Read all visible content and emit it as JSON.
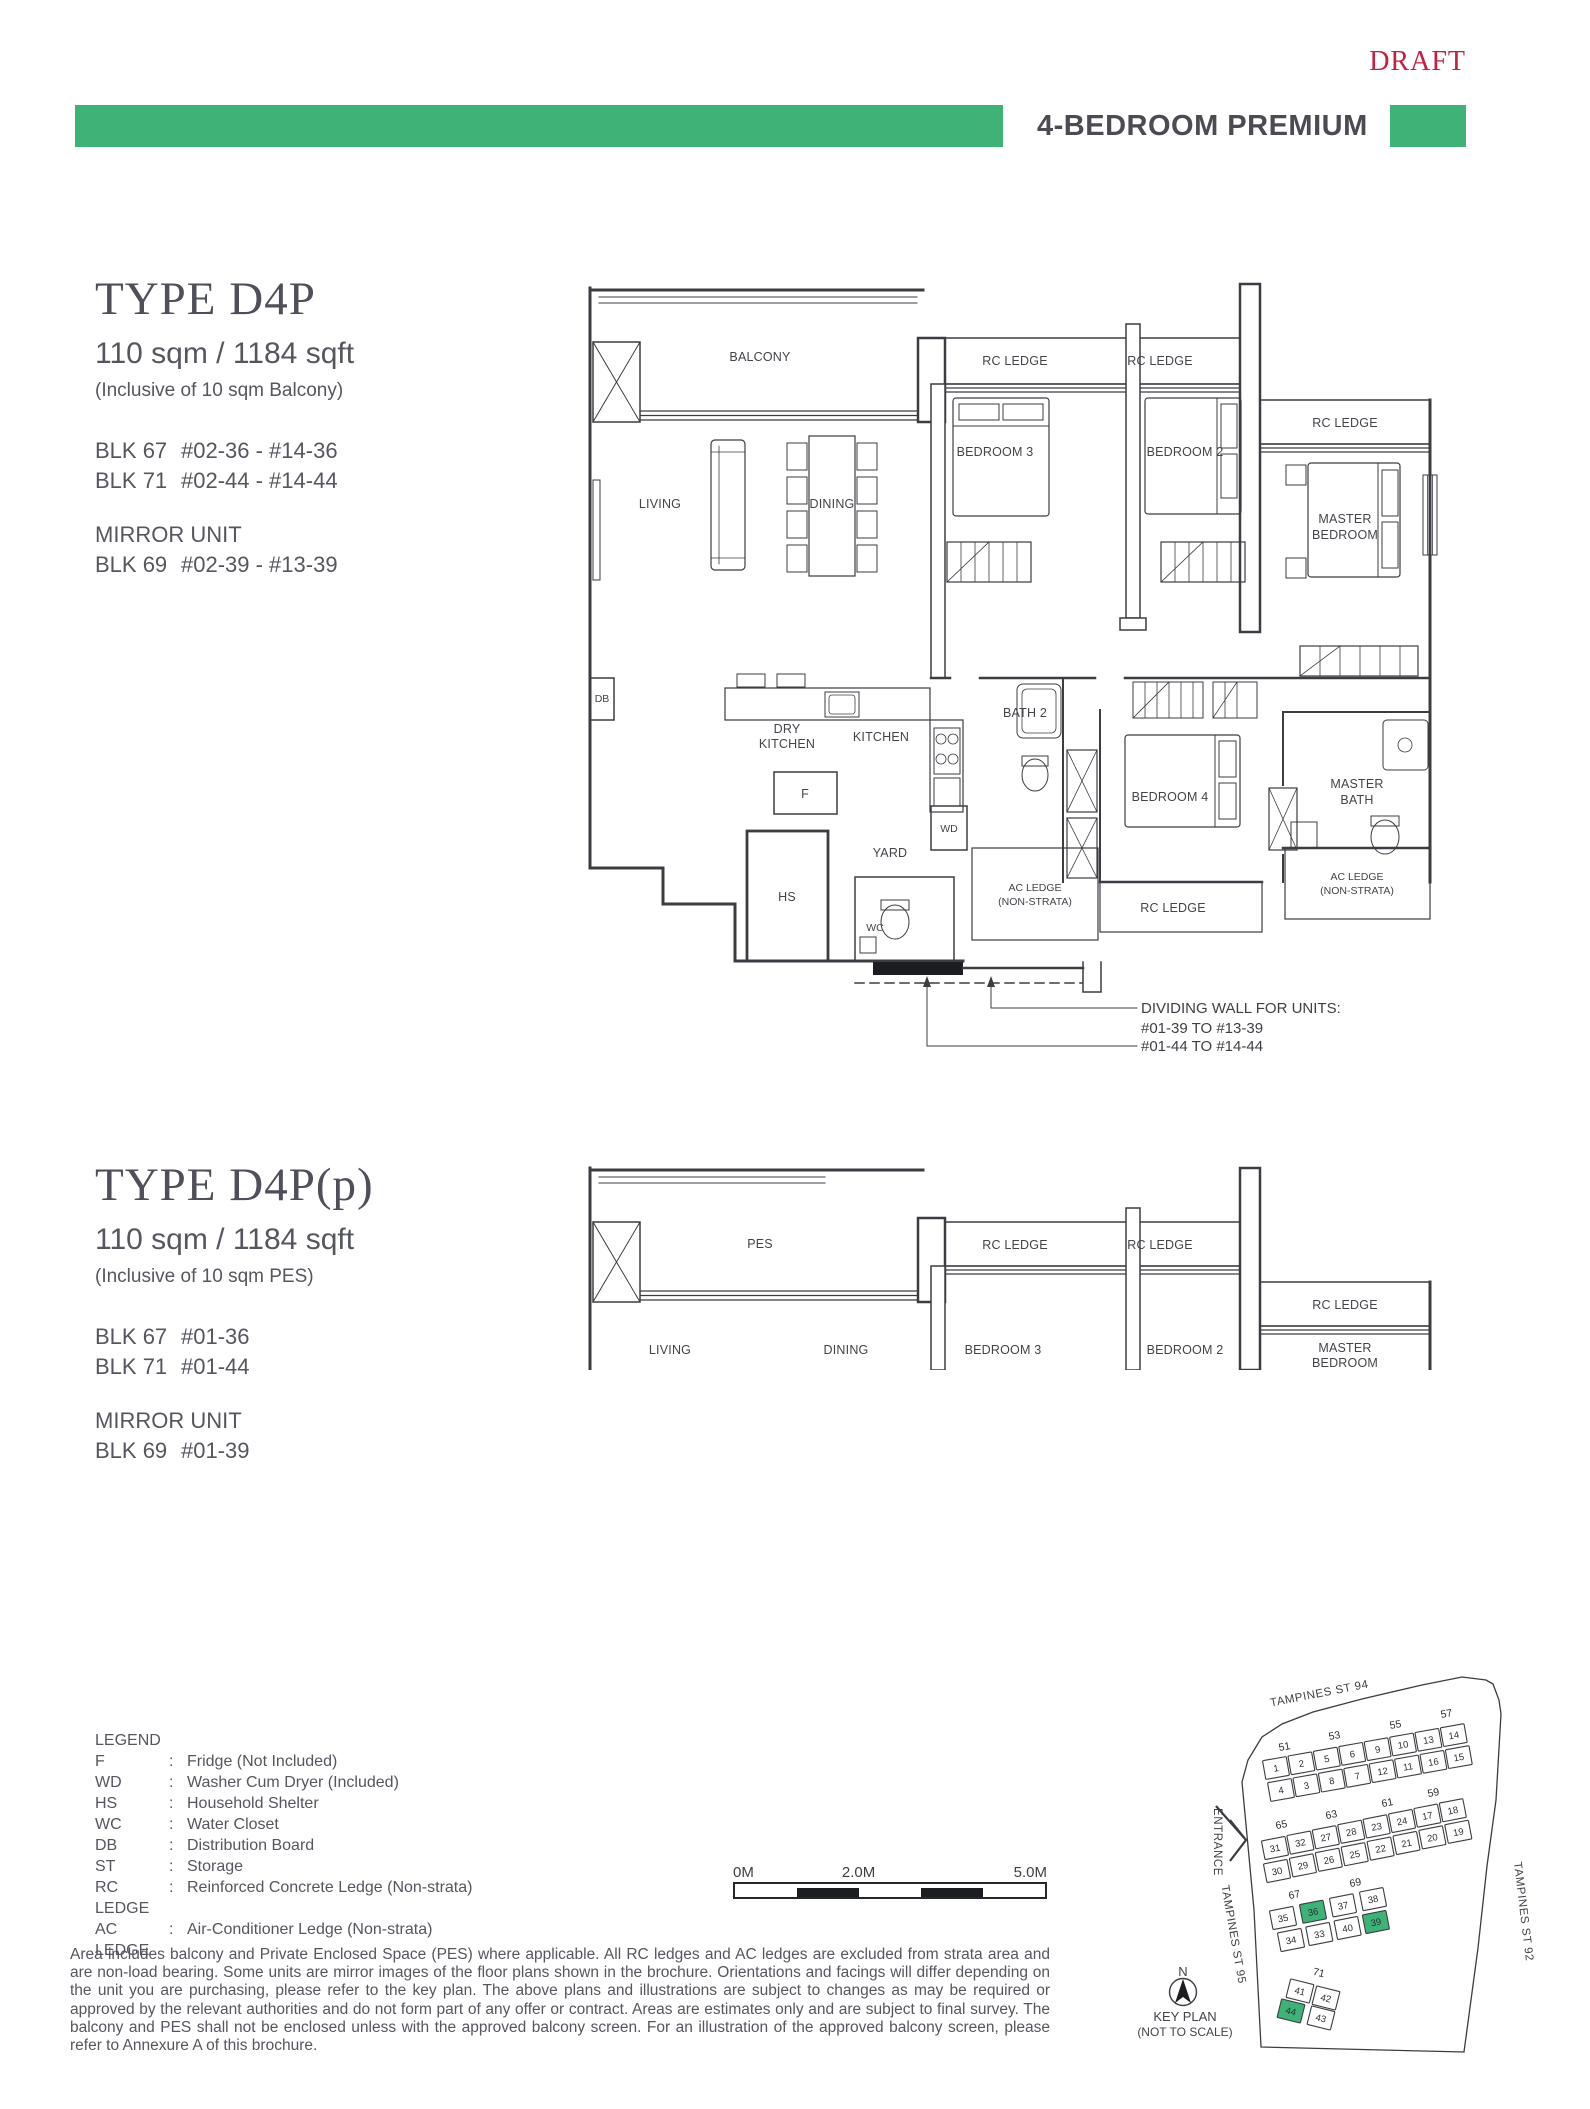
{
  "header": {
    "draft": "DRAFT",
    "banner_title": "4-BEDROOM PREMIUM"
  },
  "colors": {
    "green": "#3fb377",
    "draft_red": "#c4203e",
    "text_dark": "#4c4d55"
  },
  "unit1": {
    "title": "TYPE D4P",
    "area": "110 sqm / 1184 sqft",
    "area_note": "(Inclusive of 10 sqm Balcony)",
    "blocks": [
      {
        "blk": "BLK 67",
        "units": "#02-36 - #14-36"
      },
      {
        "blk": "BLK 71",
        "units": "#02-44 - #14-44"
      }
    ],
    "mirror_label": "MIRROR UNIT",
    "mirror_blocks": [
      {
        "blk": "BLK 69",
        "units": "#02-39 - #13-39"
      }
    ]
  },
  "unit2": {
    "title": "TYPE D4P(p)",
    "area": "110 sqm / 1184 sqft",
    "area_note": "(Inclusive of 10 sqm PES)",
    "blocks": [
      {
        "blk": "BLK 67",
        "units": "#01-36"
      },
      {
        "blk": "BLK 71",
        "units": "#01-44"
      }
    ],
    "mirror_label": "MIRROR UNIT",
    "mirror_blocks": [
      {
        "blk": "BLK 69",
        "units": "#01-39"
      }
    ]
  },
  "rooms": {
    "balcony": "BALCONY",
    "pes": "PES",
    "rc_ledge": "RC LEDGE",
    "bedroom3": "BEDROOM 3",
    "bedroom2": "BEDROOM 2",
    "bedroom4": "BEDROOM 4",
    "master_line1": "MASTER",
    "master_line2": "BEDROOM",
    "master_bath_line1": "MASTER",
    "master_bath_line2": "BATH",
    "living": "LIVING",
    "dining": "DINING",
    "dry_kitchen_line1": "DRY",
    "dry_kitchen_line2": "KITCHEN",
    "kitchen": "KITCHEN",
    "bath2": "BATH 2",
    "yard": "YARD",
    "wc": "WC",
    "hs": "HS",
    "wd": "WD",
    "db": "DB",
    "f": "F",
    "ac_ledge_line1": "AC LEDGE",
    "ac_ledge_line2": "(NON-STRATA)"
  },
  "plan1_note": [
    "DIVIDING WALL FOR UNITS:",
    "#01-39 TO #13-39",
    "#01-44 TO #14-44"
  ],
  "legend": {
    "title": "LEGEND",
    "items": [
      {
        "key": "F",
        "desc": "Fridge (Not Included)"
      },
      {
        "key": "WD",
        "desc": "Washer Cum Dryer (Included)"
      },
      {
        "key": "HS",
        "desc": "Household Shelter"
      },
      {
        "key": "WC",
        "desc": "Water Closet"
      },
      {
        "key": "DB",
        "desc": "Distribution Board"
      },
      {
        "key": "ST",
        "desc": "Storage"
      },
      {
        "key": "RC LEDGE",
        "desc": "Reinforced Concrete Ledge (Non-strata)"
      },
      {
        "key": "AC LEDGE",
        "desc": "Air-Conditioner Ledge (Non-strata)"
      }
    ]
  },
  "scalebar": {
    "start": "0M",
    "mid": "2.0M",
    "end": "5.0M"
  },
  "keyplan": {
    "street_top": "TAMPINES ST 94",
    "street_left": "TAMPINES ST 95",
    "street_right": "TAMPINES ST 92",
    "entrance": "ENTRANCE",
    "north": "N",
    "caption_line1": "KEY PLAN",
    "caption_line2": "(NOT TO SCALE)",
    "highlighted": [
      "36",
      "39",
      "44"
    ],
    "rows": [
      {
        "blocks": [
          "51",
          "53",
          "55",
          "57"
        ],
        "top": [
          "1",
          "2",
          "5",
          "6",
          "9",
          "10",
          "13",
          "14"
        ],
        "bottom": [
          "4",
          "3",
          "8",
          "7",
          "12",
          "11",
          "16",
          "15"
        ]
      },
      {
        "blocks": [
          "65",
          "63",
          "61",
          "59"
        ],
        "top": [
          "31",
          "32",
          "27",
          "28",
          "23",
          "24",
          "17",
          "18"
        ],
        "bottom": [
          "30",
          "29",
          "26",
          "25",
          "22",
          "21",
          "20",
          "19"
        ]
      },
      {
        "blocks": [
          "67",
          "69"
        ],
        "top": [
          "35",
          "36",
          "37",
          "38"
        ],
        "bottom": [
          "34",
          "33",
          "40",
          "39"
        ]
      },
      {
        "blocks": [
          "71"
        ],
        "top": [
          "41",
          "42"
        ],
        "bottom": [
          "44",
          "43"
        ]
      }
    ]
  },
  "disclaimer": "Area includes balcony and Private Enclosed Space (PES) where applicable. All RC ledges and AC ledges are excluded from strata area and are non-load bearing. Some units are mirror images of the floor plans shown in the brochure. Orientations and facings will differ depending on the unit you are purchasing, please refer to the key plan. The above plans and illustrations are subject to changes as may be required or approved by the relevant authorities and do not form part of any offer or contract. Areas are estimates only and are subject to final survey. The balcony and PES shall not be enclosed unless with the approved balcony screen. For an illustration of the approved balcony screen, please refer to Annexure A of this brochure."
}
